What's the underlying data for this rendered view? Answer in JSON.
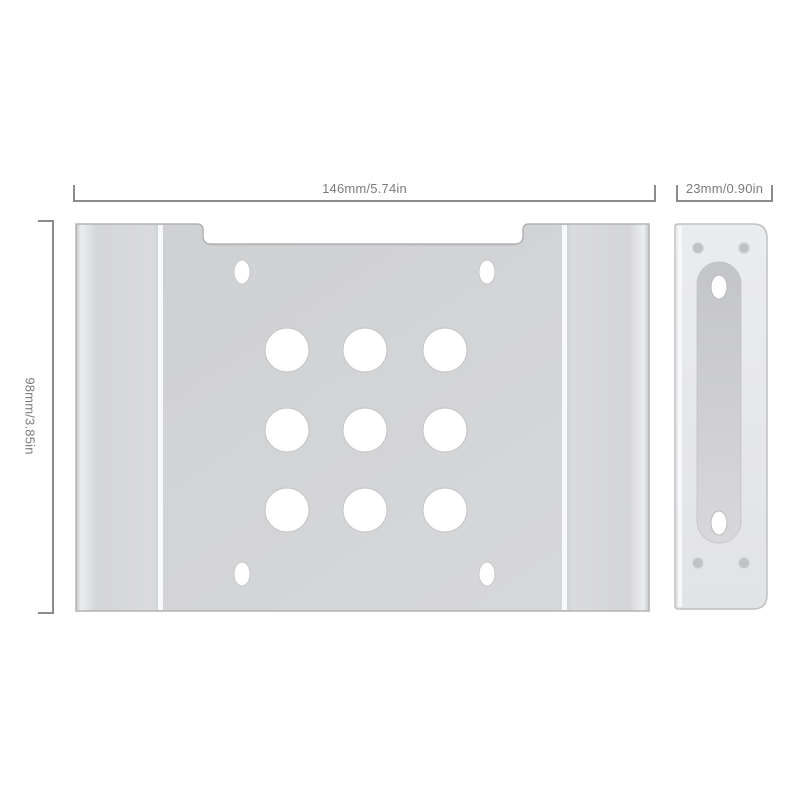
{
  "diagram": {
    "description": "Aluminum 2.5-to-3.5 inch drive mounting bracket, front view and side rail view with dimension callouts",
    "front_view": {
      "large_hole_count": 9,
      "corner_slot_count": 4
    },
    "side_view": {
      "slot_hole_count": 2,
      "screw_dimple_count": 4
    }
  },
  "dimensions": {
    "width": {
      "label": "146mm/5.74in"
    },
    "depth": {
      "label": "23mm/0.90in"
    },
    "height": {
      "label": "98mm/3.85in"
    }
  },
  "colors": {
    "background": "#ffffff",
    "dimension_line": "#8a8b8e",
    "dimension_text": "#7b7c7f",
    "metal_plate": "#d2d3d5",
    "metal_flange": "#d9dadc",
    "metal_side_rail": "#e8e9eb",
    "channel_recess": "#c9cacd",
    "fold_highlight": "#f8f9fa"
  }
}
